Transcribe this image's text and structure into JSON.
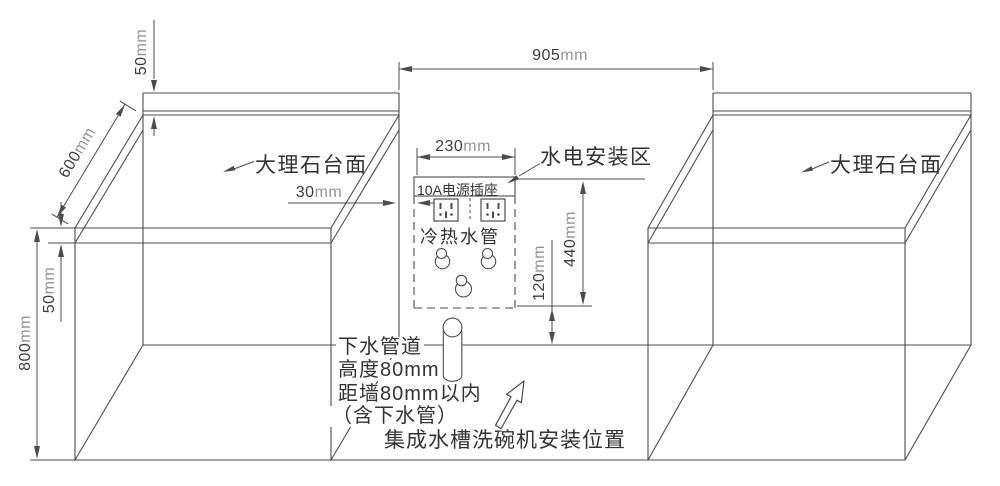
{
  "drawing": {
    "counter_left_label": "大理石台面",
    "counter_right_label": "大理石台面",
    "utility_zone_label": "水电安装区",
    "socket_label": "10A电源插座",
    "pipes_label": "冷热水管",
    "notes": {
      "drain_line1": "下水管道",
      "drain_line2": "高度80mm",
      "drain_line3": "距墙80mm以内",
      "drain_line4": "（含下水管）",
      "position_note": "集成水槽洗碗机安装位置"
    },
    "dimensions": {
      "gap_width": {
        "value": "905",
        "unit": "mm"
      },
      "backsplash_height": {
        "value": "50",
        "unit": "mm"
      },
      "counter_depth": {
        "value": "600",
        "unit": "mm"
      },
      "countertop_edge": {
        "value": "50",
        "unit": "mm"
      },
      "cabinet_height": {
        "value": "800",
        "unit": "mm"
      },
      "socket_offset": {
        "value": "30",
        "unit": "mm"
      },
      "zone_width": {
        "value": "230",
        "unit": "mm"
      },
      "zone_height": {
        "value": "440",
        "unit": "mm"
      },
      "drain_gap": {
        "value": "120",
        "unit": "mm"
      }
    }
  }
}
